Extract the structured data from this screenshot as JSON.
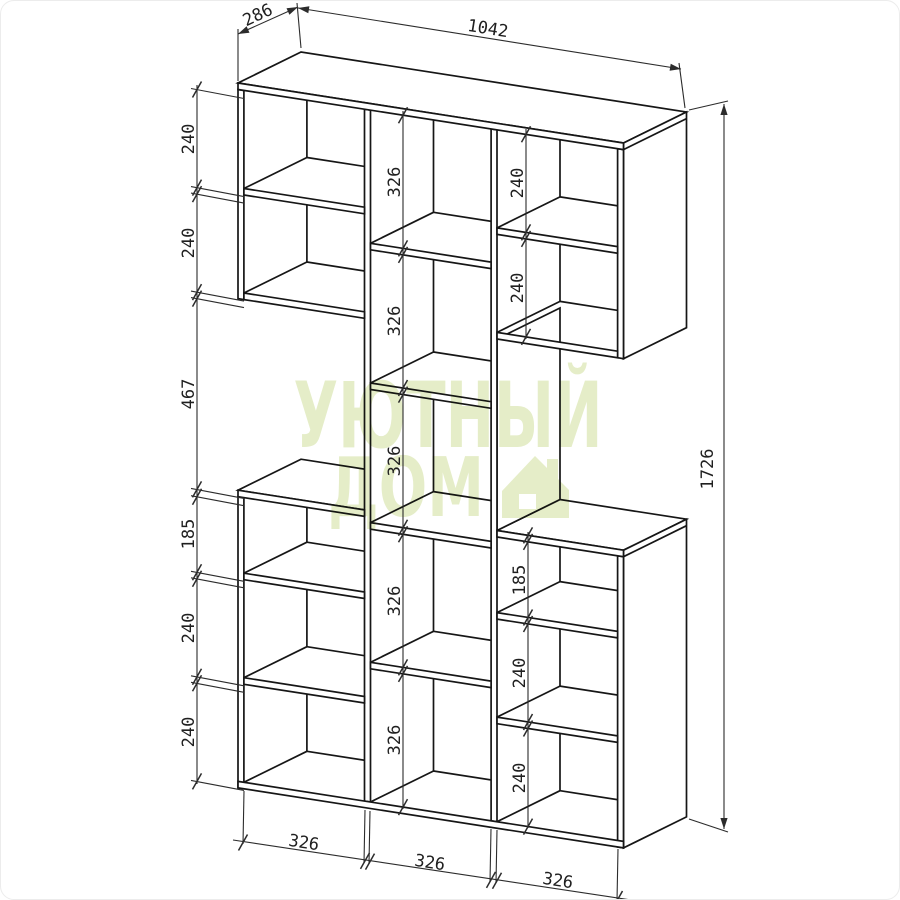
{
  "dims": {
    "depth": "286",
    "top_width": "1042",
    "height": "1726",
    "left": [
      "240",
      "240",
      "467",
      "185",
      "240",
      "240"
    ],
    "middle": [
      "326",
      "326",
      "326",
      "326",
      "326"
    ],
    "right_top": [
      "240",
      "240"
    ],
    "right_bottom": [
      "185",
      "240",
      "240"
    ],
    "bottom": [
      "326",
      "326",
      "326"
    ]
  },
  "watermark": {
    "line1": "УЮТНЫЙ",
    "line2": "ДОМ",
    "color": "#e5edc8"
  },
  "colors": {
    "line": "#161616",
    "dim_line": "#2c2c2c",
    "background": "#ffffff"
  }
}
